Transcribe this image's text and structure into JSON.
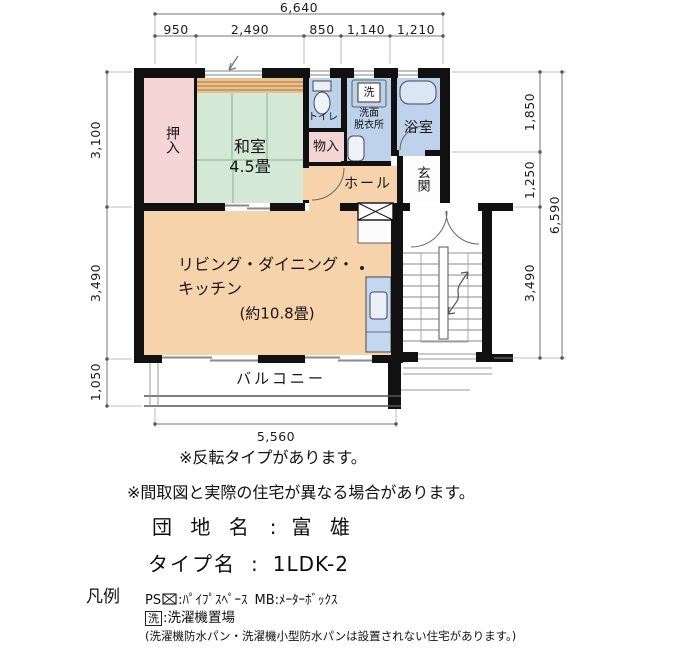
{
  "plan": {
    "dimensions": {
      "top_total": "6,640",
      "top_segments": [
        "950",
        "2,490",
        "850",
        "1,140",
        "1,210"
      ],
      "left_segments": [
        "3,100",
        "3,490",
        "1,050"
      ],
      "right_segments": [
        "1,850",
        "1,250",
        "3,490"
      ],
      "right_total": "6,590",
      "bottom_width": "5,560"
    },
    "rooms": {
      "oshiire": "押入",
      "washitsu": "和室",
      "washitsu_size": "4.5畳",
      "toilet": "トイレ",
      "storage": "物入",
      "senmen1": "洗面",
      "senmen2": "脱衣所",
      "laundry": "洗",
      "bath": "浴室",
      "genkan": "玄関",
      "hall": "ホール",
      "ldk1": "リビング・ダイニング・",
      "ldk2": "キッチン",
      "ldk3": "(約10.8畳)",
      "balcony": "バルコニー"
    }
  },
  "notes": {
    "reverse": "※反転タイプがあります。",
    "differ": "※間取図と実際の住宅が異なる場合があります。"
  },
  "property": {
    "estate_label": "団 地 名",
    "estate_colon": ":",
    "estate_value": "富 雄",
    "type_label": "タイプ名",
    "type_colon": ":",
    "type_value": "1LDK-2"
  },
  "legend": {
    "title": "凡例",
    "ps": "PS",
    "ps_desc": ":ﾊﾟｲﾌﾟｽﾍﾟｰｽ",
    "mb": "MB",
    "mb_desc": ":ﾒｰﾀｰﾎﾞｯｸｽ",
    "laundry_mark": "洗",
    "laundry_desc": ":洗濯機置場",
    "laundry_note": "(洗濯機防水パン・洗濯機小型防水パンは設置されない住宅があります。)"
  },
  "colors": {
    "wall": "#111111",
    "tatami_green": "#d3e9d5",
    "closet_pink": "#f6d5d6",
    "ldk_orange": "#f6d3ab",
    "wet_blue": "#bed3eb",
    "stripe_band": "#e9c08e"
  }
}
